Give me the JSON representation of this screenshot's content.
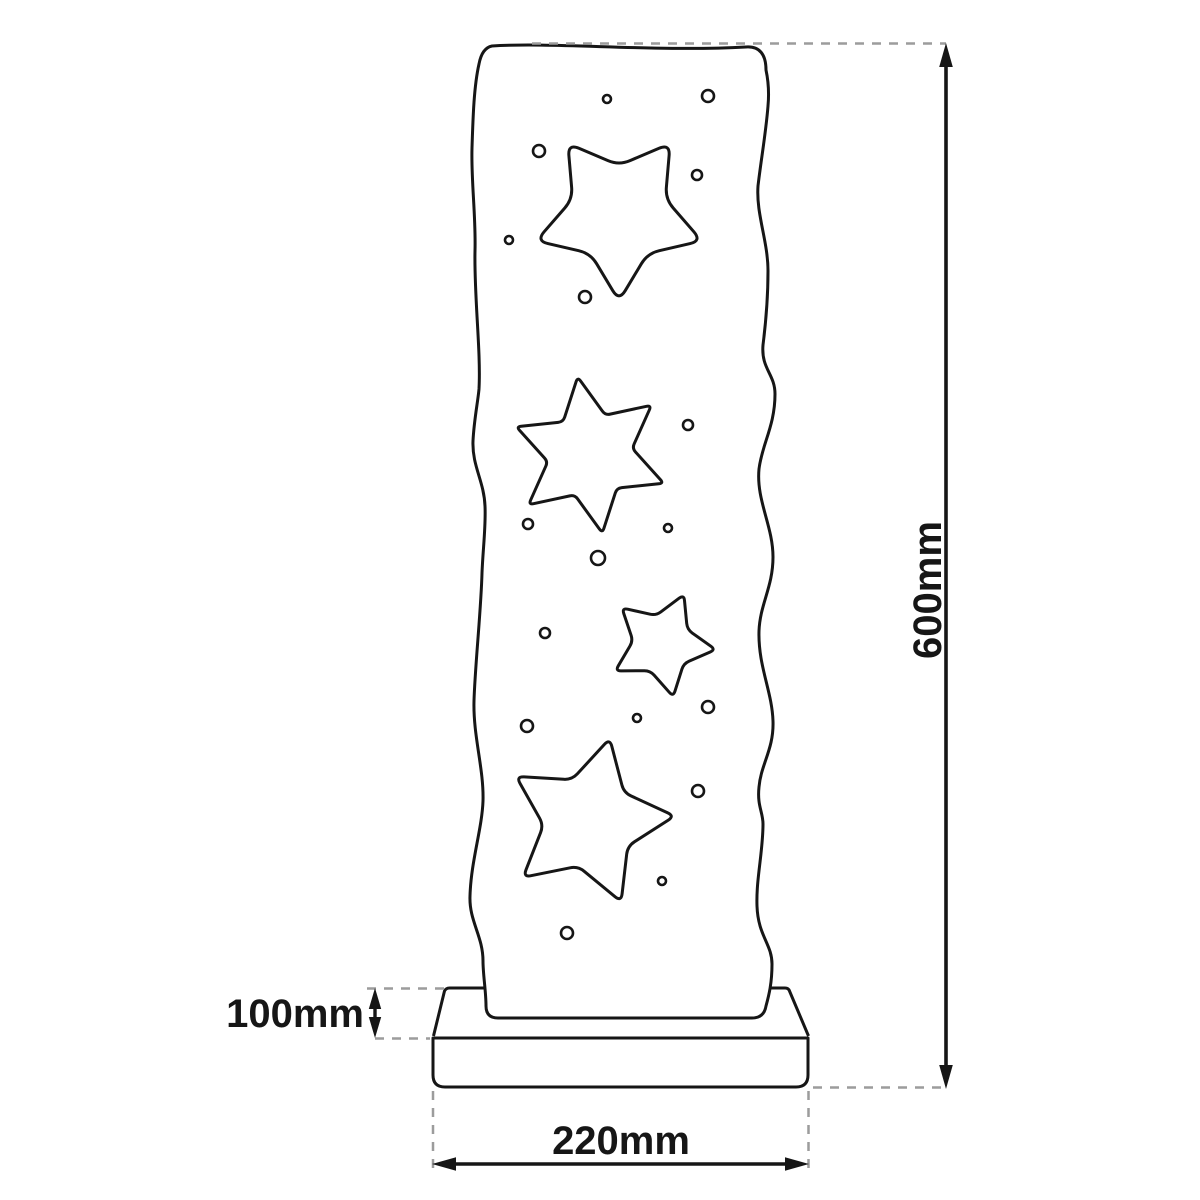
{
  "dimension_labels": {
    "height": "600mm",
    "base_height": "100mm",
    "width": "220mm"
  },
  "colors": {
    "outline": "#161616",
    "dashed_guide": "#9c9c9c",
    "background": "#ffffff"
  },
  "drawing": {
    "description": "front-view outline of a wavy-edged panel with star and circle cutouts standing on a two-tier base",
    "stars": [
      {
        "name": "star-cutout-top-inverted",
        "points": 5,
        "cx": 619,
        "cy": 214,
        "outer_r": 87,
        "inner_ratio": 0.56,
        "rotation_deg": 90,
        "corner_r": 12
      },
      {
        "name": "star-cutout-six-point",
        "points": 6,
        "cx": 590,
        "cy": 455,
        "outer_r": 79,
        "inner_ratio": 0.54,
        "rotation_deg": -99,
        "corner_r": 5
      },
      {
        "name": "star-cutout-small",
        "points": 5,
        "cx": 662,
        "cy": 644,
        "outer_r": 54,
        "inner_ratio": 0.54,
        "rotation_deg": -66,
        "corner_r": 6
      },
      {
        "name": "star-cutout-bottom-large",
        "points": 5,
        "cx": 589,
        "cy": 822,
        "outer_r": 86,
        "inner_ratio": 0.53,
        "rotation_deg": -76,
        "corner_r": 8
      }
    ],
    "holes": [
      {
        "cx": 607,
        "cy": 99,
        "r": 4
      },
      {
        "cx": 708,
        "cy": 96,
        "r": 6
      },
      {
        "cx": 539,
        "cy": 151,
        "r": 6
      },
      {
        "cx": 697,
        "cy": 175,
        "r": 5
      },
      {
        "cx": 509,
        "cy": 240,
        "r": 4
      },
      {
        "cx": 585,
        "cy": 297,
        "r": 6
      },
      {
        "cx": 688,
        "cy": 425,
        "r": 5
      },
      {
        "cx": 528,
        "cy": 524,
        "r": 5
      },
      {
        "cx": 668,
        "cy": 528,
        "r": 4
      },
      {
        "cx": 598,
        "cy": 558,
        "r": 7
      },
      {
        "cx": 545,
        "cy": 633,
        "r": 5
      },
      {
        "cx": 708,
        "cy": 707,
        "r": 6
      },
      {
        "cx": 637,
        "cy": 718,
        "r": 4
      },
      {
        "cx": 527,
        "cy": 726,
        "r": 6
      },
      {
        "cx": 698,
        "cy": 791,
        "r": 6
      },
      {
        "cx": 662,
        "cy": 881,
        "r": 4
      },
      {
        "cx": 567,
        "cy": 933,
        "r": 6
      }
    ]
  }
}
